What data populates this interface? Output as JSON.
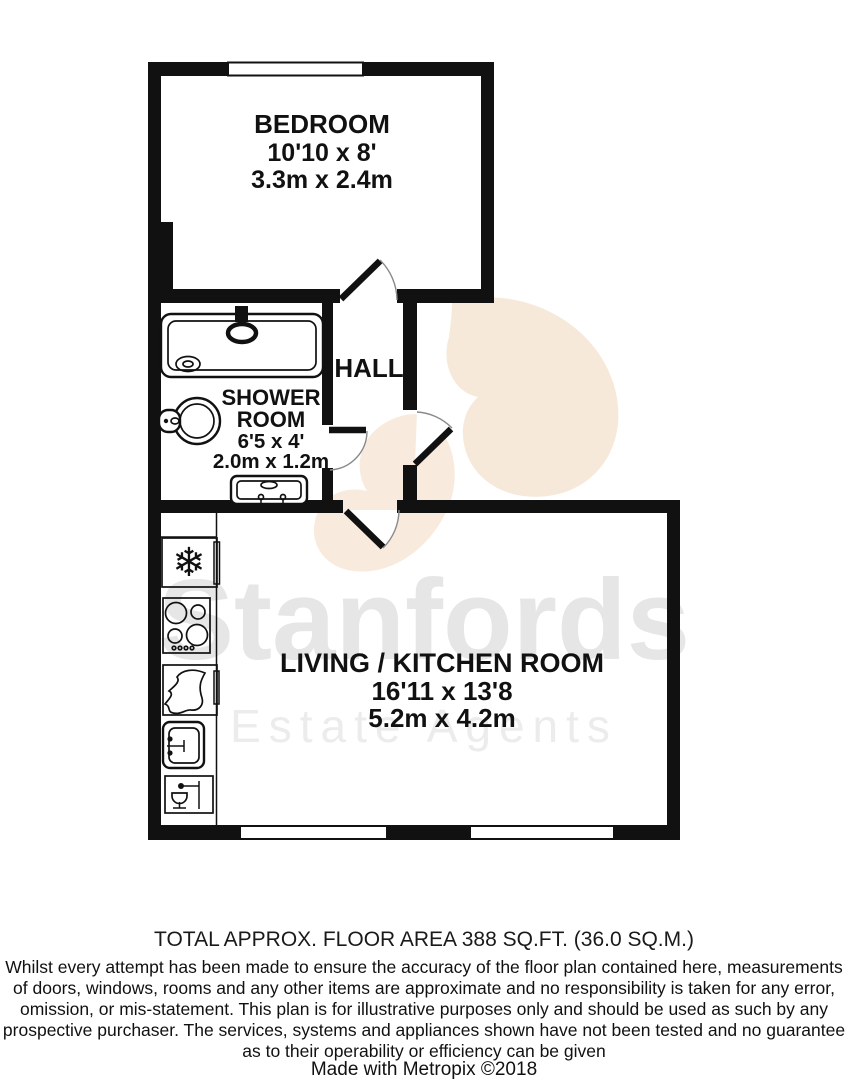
{
  "watermark": {
    "brand": "Stanfords",
    "tagline": "Estate Agents"
  },
  "icons": {
    "freezer": "❄"
  },
  "rooms": {
    "bedroom": {
      "name": "BEDROOM",
      "imperial": "10'10 x 8'",
      "metric": "3.3m x 2.4m"
    },
    "hall": {
      "name": "HALL"
    },
    "shower_room": {
      "line1": "SHOWER",
      "line2": "ROOM",
      "imperial": "6'5 x 4'",
      "metric": "2.0m x 1.2m"
    },
    "living_kitchen": {
      "name": "LIVING / KITCHEN ROOM",
      "imperial": "16'11 x 13'8",
      "metric": "5.2m x 4.2m"
    }
  },
  "footer": {
    "total_area": "TOTAL APPROX. FLOOR AREA 388 SQ.FT. (36.0 SQ.M.)",
    "disclaimer_lines": [
      "Whilst every attempt has been made to ensure the accuracy of the floor plan contained here, measurements",
      "of doors, windows, rooms and any other items are approximate and no responsibility is taken for any error,",
      "omission, or mis-statement. This plan is for illustrative purposes only and should be used as such by any",
      "prospective purchaser. The services, systems and appliances shown have not been tested and no guarantee",
      "as to their operability or efficiency can be given"
    ],
    "credit": "Made with Metropix ©2018"
  },
  "colors": {
    "wall": "#111111",
    "watermark_text": "#e6e6e6",
    "logo_blob": "#f5e3d1",
    "background": "#ffffff"
  }
}
